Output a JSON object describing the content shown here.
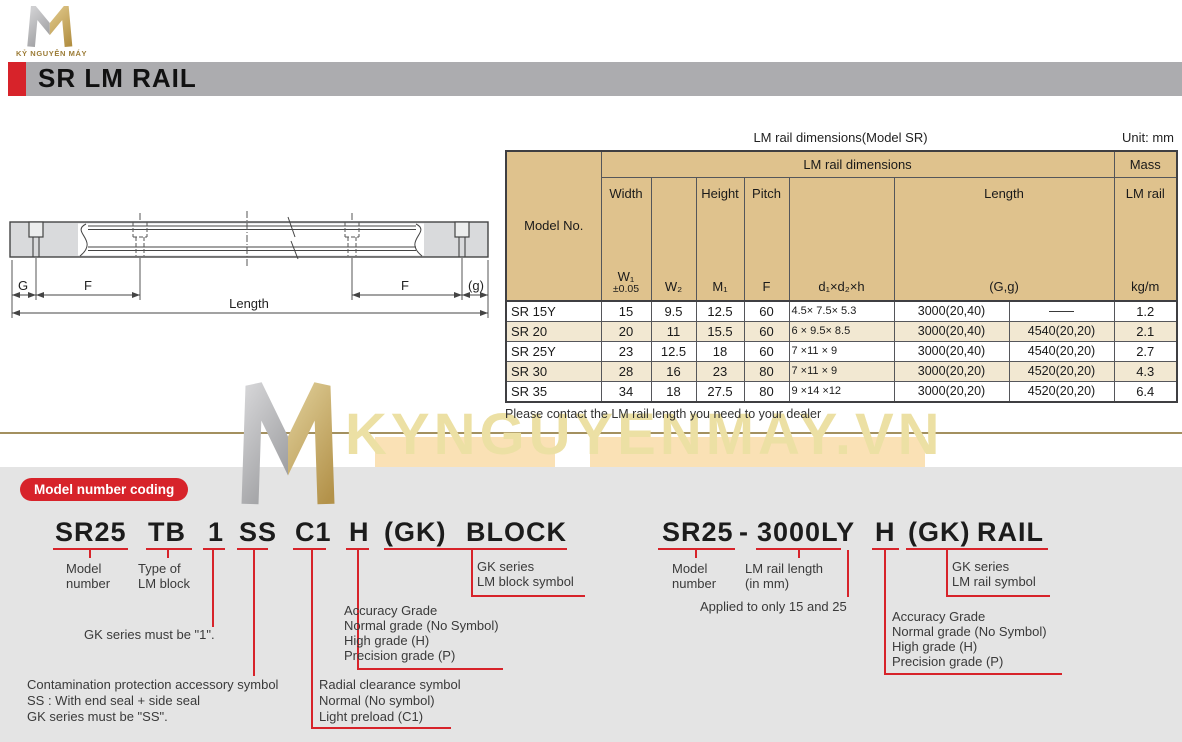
{
  "colors": {
    "accent_red": "#d7232a",
    "header_bar_gray": "#acacaf",
    "table_header_tan": "#dfc28d",
    "table_row_alt": "#f2e8d2",
    "panel_gray": "#e4e4e4",
    "watermark_gold": "#ece0a4",
    "divider_brown": "#a3905f"
  },
  "logo": {
    "brand": "KỶ NGUYÊN MÁY"
  },
  "header": {
    "title": "SR LM RAIL"
  },
  "drawing": {
    "labels": {
      "g": "G",
      "f_left": "F",
      "f_right": "F",
      "g_small": "(g)",
      "length": "Length"
    }
  },
  "table": {
    "title": "LM rail dimensions(Model SR)",
    "unit": "Unit: mm",
    "group_header": "LM rail dimensions",
    "mass_header": "Mass",
    "model_header": "Model No.",
    "sub": {
      "width_top": "Width",
      "width_sym": "W₁",
      "width_tol": "±0.05",
      "w2_sym": "W₂",
      "height_top": "Height",
      "height_sym": "M₁",
      "pitch_top": "Pitch",
      "pitch_sym": "F",
      "holes_sym": "d₁×d₂×h",
      "length_top": "Length",
      "length_sym": "(G,g)",
      "mass_top": "LM rail",
      "mass_sym": "kg/m"
    },
    "rows": [
      {
        "model": "SR 15Y",
        "w1": "15",
        "w2": "9.5",
        "m1": "12.5",
        "f": "60",
        "holes": "4.5× 7.5× 5.3",
        "len1": "3000(20,40)",
        "len2": "——",
        "mass": "1.2"
      },
      {
        "model": "SR 20",
        "w1": "20",
        "w2": "11",
        "m1": "15.5",
        "f": "60",
        "holes": "6 × 9.5× 8.5",
        "len1": "3000(20,40)",
        "len2": "4540(20,20)",
        "mass": "2.1"
      },
      {
        "model": "SR 25Y",
        "w1": "23",
        "w2": "12.5",
        "m1": "18",
        "f": "60",
        "holes": "7 ×11 × 9",
        "len1": "3000(20,40)",
        "len2": "4540(20,20)",
        "mass": "2.7"
      },
      {
        "model": "SR 30",
        "w1": "28",
        "w2": "16",
        "m1": "23",
        "f": "80",
        "holes": "7 ×11 × 9",
        "len1": "3000(20,20)",
        "len2": "4520(20,20)",
        "mass": "4.3"
      },
      {
        "model": "SR 35",
        "w1": "34",
        "w2": "18",
        "m1": "27.5",
        "f": "80",
        "holes": "9 ×14 ×12",
        "len1": "3000(20,20)",
        "len2": "4520(20,20)",
        "mass": "6.4"
      }
    ],
    "note": "Please contact the LM rail length you need to your dealer"
  },
  "watermark": {
    "text": "KYNGUYENMAY.VN"
  },
  "coding": {
    "badge": "Model number coding",
    "block": {
      "t_model": "SR25",
      "t_type": "TB",
      "t_one": "1",
      "t_ss": "SS",
      "t_c1": "C1",
      "t_h": "H",
      "t_gk": "(GK)",
      "t_block": "BLOCK",
      "model_label": "Model number",
      "type_label": "Type of LM block",
      "one_note": "GK series must be \"1\".",
      "contamination": [
        "Contamination protection accessory symbol",
        "SS : With end seal + side seal",
        "GK series must be \"SS\"."
      ],
      "radial": [
        "Radial clearance symbol",
        "Normal (No symbol)",
        "Light preload (C1)"
      ],
      "accuracy": [
        "Accuracy Grade",
        "Normal grade (No Symbol)",
        "High grade (H)",
        "Precision grade (P)"
      ],
      "gk_series": [
        "GK series",
        "LM block symbol"
      ]
    },
    "rail": {
      "t_model": "SR25",
      "t_dash": "-",
      "t_len": "3000LY",
      "t_h": "H",
      "t_gk": "(GK)",
      "t_rail": "RAIL",
      "model_label": "Model number",
      "len_label": [
        "LM rail length",
        "(in mm)"
      ],
      "applied_note": "Applied to only 15 and 25",
      "accuracy": [
        "Accuracy Grade",
        "Normal grade (No Symbol)",
        "High grade (H)",
        "Precision grade (P)"
      ],
      "gk_series": [
        "GK series",
        "LM rail symbol"
      ]
    }
  }
}
